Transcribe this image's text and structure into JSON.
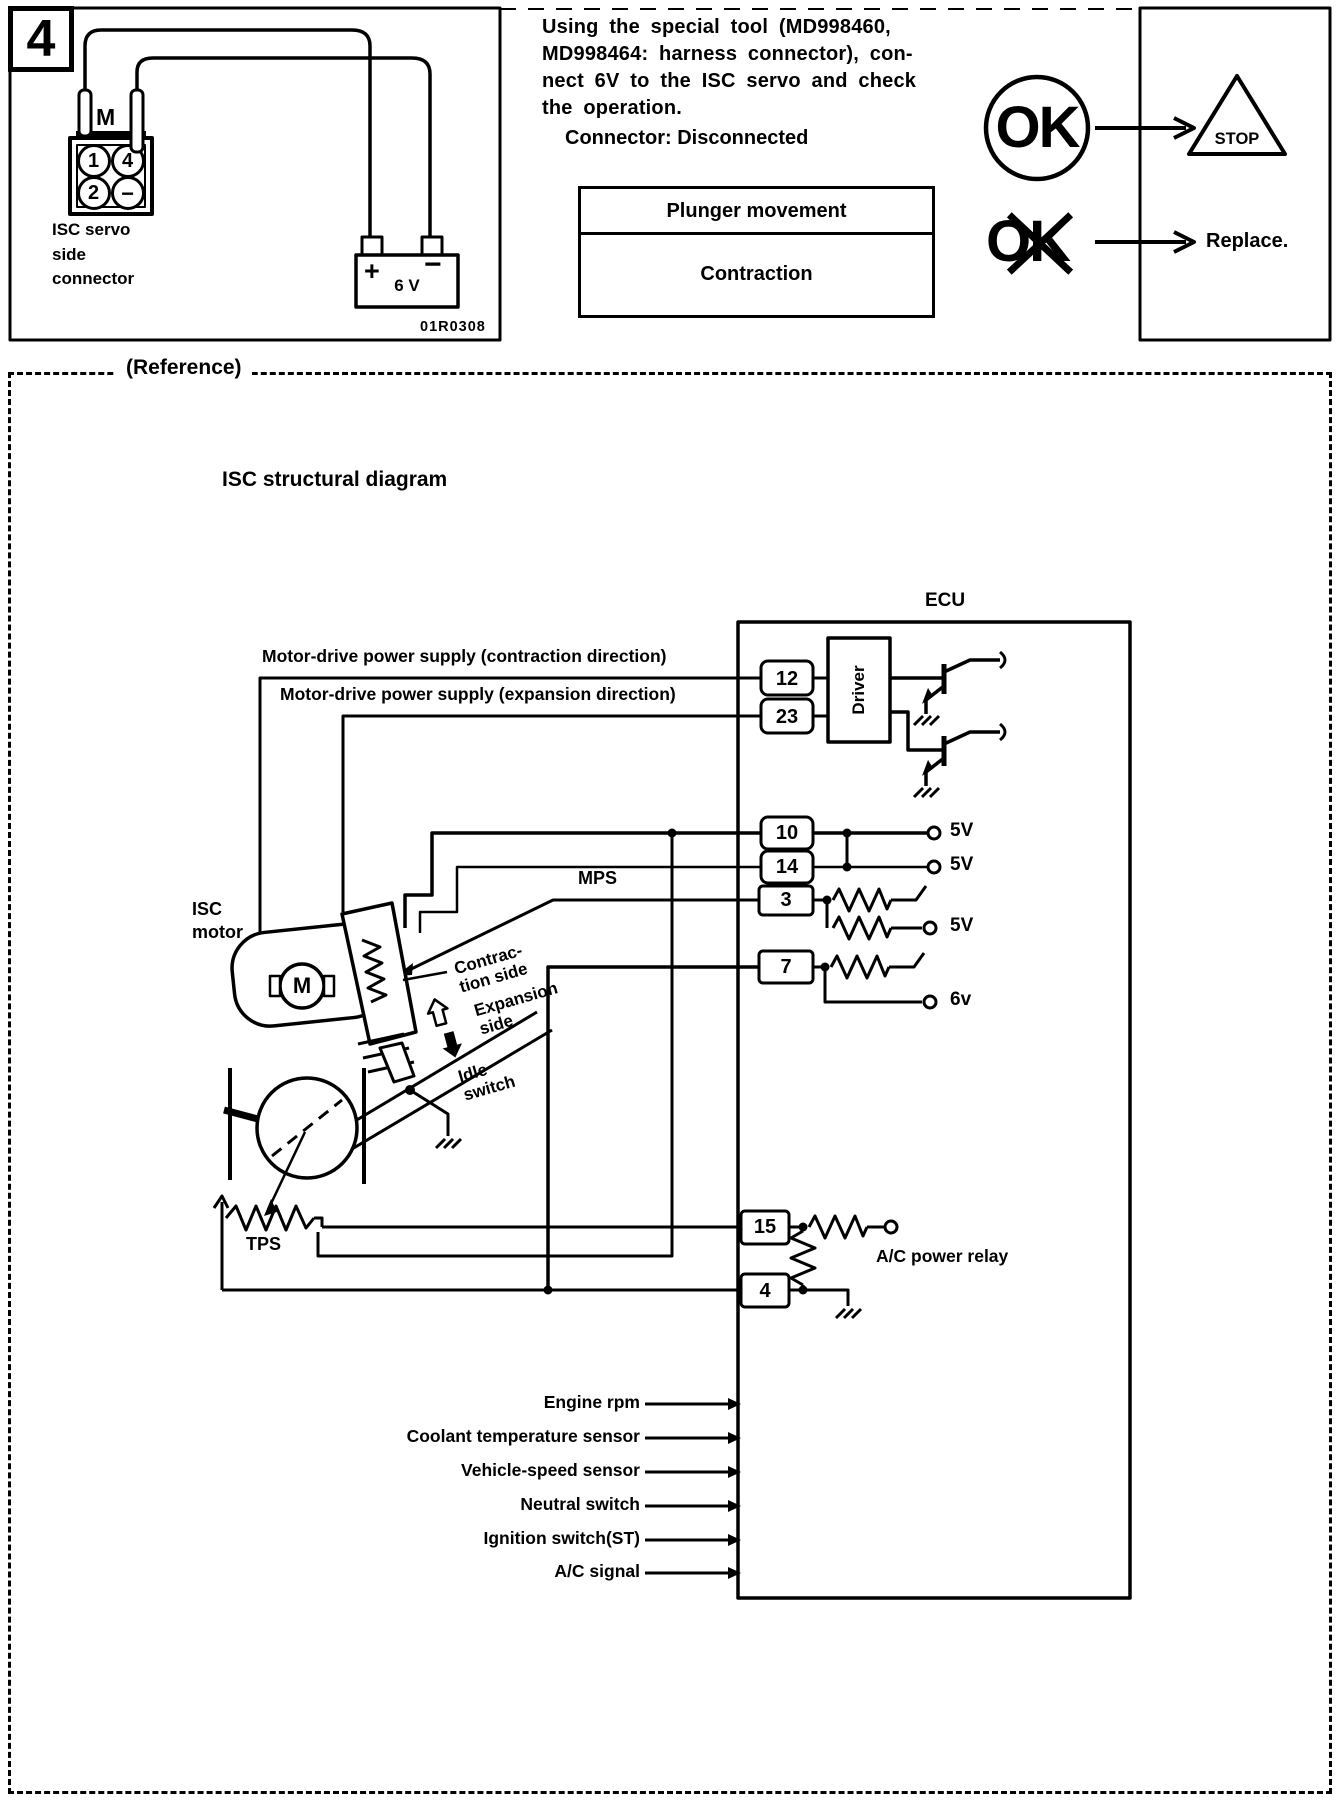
{
  "step": {
    "number": "4",
    "figure_code": "01R0308"
  },
  "left_figure": {
    "caption": "ISC servo\nside\nconnector",
    "motor_mark": "M",
    "pin_labels": [
      "1",
      "4",
      "2",
      "−"
    ],
    "battery": {
      "plus": "+",
      "minus": "−",
      "label": "6 V"
    }
  },
  "procedure": {
    "instruction": "Using the special tool (MD998460,\nMD998464: harness connector), con-\nnect 6V to the ISC servo and check\nthe operation.",
    "connector_state": "Connector: Disconnected",
    "table": {
      "header": "Plunger movement",
      "value": "Contraction"
    },
    "ok_symbol": "OK",
    "ng_symbol": "OK",
    "stop_label": "STOP",
    "replace_label": "Replace."
  },
  "reference": {
    "box_label": "(Reference)",
    "heading": "ISC structural diagram",
    "ecu_label": "ECU",
    "driver_label": "Driver",
    "supply_contraction": "Motor-drive power supply (contraction direction)",
    "supply_expansion": "Motor-drive power supply (expansion direction)",
    "mps": "MPS",
    "isc_motor": "ISC\nmotor",
    "motor_mark": "M",
    "contraction_side": "Contrac-\ntion side",
    "expansion_side": "Expansion\nside",
    "idle_switch": "Idle\nswitch",
    "tps": "TPS",
    "ac_power_relay": "A/C power relay",
    "pins": {
      "p12": "12",
      "p23": "23",
      "p10": "10",
      "p14": "14",
      "p3": "3",
      "p7": "7",
      "p15": "15",
      "p4": "4"
    },
    "terminals": {
      "t10": "5V",
      "t14": "5V",
      "t3": "5V",
      "t7": "6v"
    },
    "inputs": [
      "Engine rpm",
      "Coolant temperature sensor",
      "Vehicle-speed sensor",
      "Neutral switch",
      "Ignition switch(ST)",
      "A/C signal"
    ]
  }
}
